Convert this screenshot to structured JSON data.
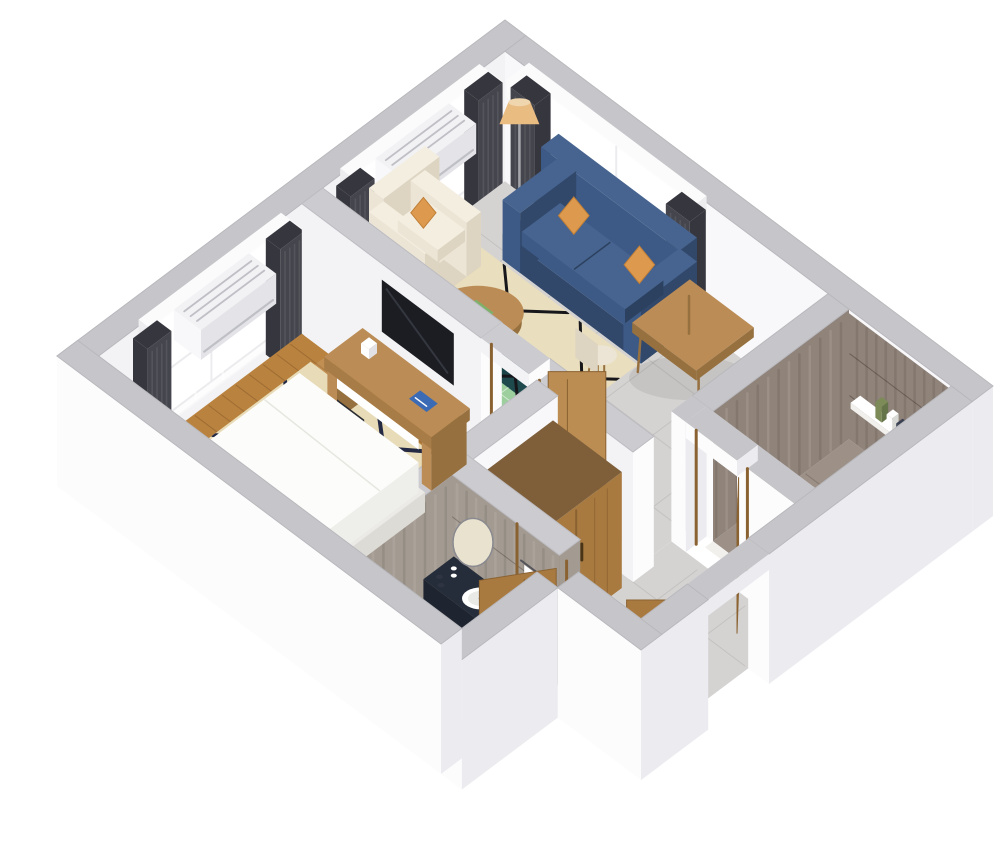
{
  "scene": {
    "kind": "3d-floor-plan-cutaway-render",
    "rooms": [
      {
        "name": "living-room",
        "items": [
          "blue-sofa",
          "orange-pillows",
          "cream-armchair",
          "cream-ottoman",
          "round-coffee-table",
          "floor-lamp",
          "area-rug",
          "dining-table",
          "dining-chairs",
          "window-curtains",
          "air-conditioner"
        ]
      },
      {
        "name": "bedroom",
        "items": [
          "double-bed-white",
          "desk",
          "office-chair",
          "wall-mounted-tv",
          "area-rug",
          "wood-floor",
          "window-curtains",
          "air-conditioner",
          "door"
        ]
      },
      {
        "name": "bathroom",
        "items": [
          "dark-vanity",
          "oval-sink",
          "round-mirror",
          "toiletries",
          "towels",
          "toilet",
          "wood-door",
          "marble-walls",
          "floor-mat"
        ]
      },
      {
        "name": "shower-room",
        "items": [
          "marble-walls",
          "marble-floor",
          "shelf",
          "toiletries",
          "wood-door"
        ]
      },
      {
        "name": "hallway",
        "items": [
          "wardrobe-sliding-doors",
          "entry-door",
          "dark-bench",
          "tile-floor"
        ]
      }
    ]
  },
  "colors": {
    "bg": "#ffffff",
    "wallTop": "#c6c6ca",
    "wallTopInner": "#cbcbd0",
    "wallTopLight": "#e4e4e8",
    "wallBright": "#fcfcfd",
    "wallShade": "#ececf0",
    "wallInner": "#f3f3f5",
    "wallInnerBright": "#f8f8fa",
    "tileFloor": "#d5d3d2",
    "tileLine": "rgba(110,105,100,0.16)",
    "woodFloor": "#b9823f",
    "woodPlank": "rgba(96,58,22,0.30)",
    "woodLight": "rgba(255,240,215,0.12)",
    "rugBed": "#e8dcb8",
    "rugLineNavy": "#252a44",
    "rugLiving": "#e9debd",
    "rugLineBlack": "#17171b",
    "rugTeal": "#1e4a4e",
    "rugGreen": "#9ccf9d",
    "sofa": "#3d5a86",
    "sofaDark": "#31486b",
    "sofaLight": "#46648f",
    "cushionSeam": "#2c415f",
    "pillowOrange": "#dd9a4e",
    "pillowOrangeDark": "#c07f38",
    "cream": "#ece5d6",
    "creamDark": "#ddd4c1",
    "creamLight": "#f4eee1",
    "wood": "#bb8c55",
    "woodDark": "#96703f",
    "curtain": "#45454d",
    "curtainDark": "#36363e",
    "curtainFold": "#54545c",
    "sheer": "#ffffff",
    "frame": "#fbfbfc",
    "glass": "#ffffff",
    "mullion": "#dfdfe4",
    "ac": "#f2f2f4",
    "acSide": "#e4e4e8",
    "acGrille": "#bfbfc6",
    "tv": "#1b1d22",
    "tvGlare": "#34373f",
    "chairDark": "#34353b",
    "chairDarker": "#2b2c31",
    "marble": "#8f837a",
    "marbleDark": "#786c63",
    "marbleLight": "#a89c92",
    "marbleBath": "#a39b92",
    "marbleBathDark": "#8b847b",
    "marbleFloor": "#9c9087",
    "vanityTop": "#262d3a",
    "vanityFront": "#1f2530",
    "vanitySide": "#181d27",
    "white": "#ffffff",
    "offWhite": "#f1f0ec",
    "mat": "#eceae6",
    "doorWood": "#a87a40",
    "doorWoodDark": "#8a6232",
    "doorWoodLight": "#bb8d52",
    "lampShade": "#e9bc82",
    "lampShadeTop": "#f0d6ae",
    "metal": "#a5a5ab",
    "folderBlue": "#3b6bb5",
    "bookGreen": "#7fb069",
    "bottleGreen": "#7c8b58",
    "benchDark": "#232a34",
    "shadow": "rgba(0,0,0,0.07)",
    "mirror": "#e9e2cf",
    "mirrorRim": "#8a8a90"
  }
}
